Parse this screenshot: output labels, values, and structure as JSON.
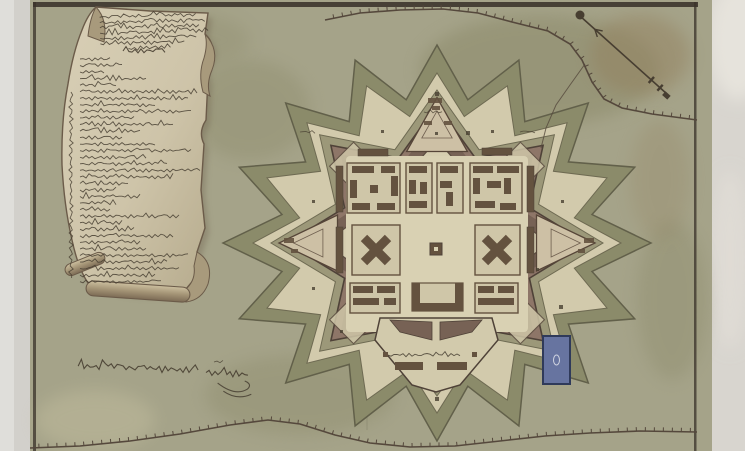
{
  "scene": {
    "width": 745,
    "height": 451,
    "photo": {
      "background": "#d2d0cb",
      "left_band": "#e0dfdb",
      "right_band": "#d8d5cf",
      "corner_highlight": "#e6e3dc"
    },
    "map_sheet": {
      "x": 30,
      "width": 682,
      "paper": "#a5a389",
      "paper_light": "#c8c2a2",
      "paper_dark": "#8a8868",
      "stain_brown": "#937f5c",
      "frame_color": "#3a322a",
      "frame_top_y": 2,
      "frame_left_x": 33,
      "frame_right_x": 694,
      "frame_thickness": 4,
      "crease_x": 367
    }
  },
  "palette": {
    "ink": "#473e31",
    "ink_light": "#5d5243",
    "glacis": "#8b8b6a",
    "glacis_edge": "#62604a",
    "covered_way": "#d2caac",
    "ditch": "#9c9879",
    "ditch_edge": "#6e6a52",
    "rampart": "#8e7668",
    "rampart_core": "#776255",
    "rampart_edge": "#4f4238",
    "enceinte": "#d6ceb0",
    "enceinte_edge": "#5c4d41",
    "parade": "#d9d1b3",
    "block_fill": "#cfc6a8",
    "building": "#64523f",
    "ravelin_fill": "#cdc0a5",
    "ravelin_edge": "#564538",
    "pond_fill": "#6774a0",
    "pond_edge": "#2f3a5a",
    "cartouche_paper": "#d2c8ae",
    "cartouche_paper_dark": "#bfb496",
    "cartouche_curl": "#a89a7c",
    "cartouche_edge": "#6b5b49",
    "road_ink": "#55483c"
  },
  "fort": {
    "cx": 437,
    "cy": 243,
    "rings": [
      {
        "name": "glacis",
        "n": 16,
        "rxo": 214,
        "ryo": 198,
        "rxi": 158,
        "ryi": 146,
        "fill": "glacis",
        "stroke": "glacis_edge",
        "sw": 1.5
      },
      {
        "name": "covered-way",
        "n": 16,
        "rxo": 184,
        "ryo": 170,
        "rxi": 140,
        "ryi": 129,
        "fill": "covered_way",
        "stroke": "ditch_edge",
        "sw": 1
      },
      {
        "name": "ditch",
        "n": 8,
        "rxo": 166,
        "ryo": 153,
        "rxi": 110,
        "ryi": 101,
        "fill": "ditch",
        "stroke": "ditch_edge",
        "sw": 1
      },
      {
        "name": "rampart",
        "n": 8,
        "rxo": 150,
        "ryo": 138,
        "rxi": 100,
        "ryi": 92,
        "fill": "rampart",
        "stroke": "rampart_edge",
        "sw": 1.6
      },
      {
        "name": "rampart-core",
        "n": 8,
        "rxo": 136,
        "ryo": 125,
        "rxi": 92,
        "ryi": 85,
        "fill": "rampart_core",
        "stroke": "",
        "sw": 0
      },
      {
        "name": "enceinte",
        "n": 8,
        "rxo": 112,
        "ryo": 103,
        "rxi": 80,
        "ryi": 74,
        "fill": "enceinte",
        "stroke": "enceinte_edge",
        "sw": 1.2
      }
    ],
    "ravelin_dirs_deg": [
      -90,
      0,
      180
    ],
    "ravelin": {
      "apex_r": 158,
      "base_r": 104,
      "half_angle_deg": 17,
      "y_scale": 0.92
    },
    "bastion_diamond": {
      "dirs_deg": [
        -45,
        -135,
        45,
        135
      ],
      "r": 118,
      "size": 24
    },
    "parade": {
      "x": 346,
      "y": 156,
      "w": 182,
      "h": 176
    },
    "blocks": [
      {
        "outline": [
          347,
          163,
          53,
          50
        ],
        "rects": [
          [
            352,
            166,
            22,
            7
          ],
          [
            381,
            166,
            14,
            7
          ],
          [
            350,
            180,
            7,
            18
          ],
          [
            391,
            176,
            7,
            20
          ],
          [
            352,
            203,
            18,
            7
          ],
          [
            377,
            203,
            18,
            7
          ],
          [
            370,
            185,
            8,
            8
          ]
        ]
      },
      {
        "outline": [
          406,
          163,
          26,
          50
        ],
        "rects": [
          [
            409,
            166,
            18,
            7
          ],
          [
            409,
            180,
            7,
            14
          ],
          [
            420,
            182,
            7,
            12
          ],
          [
            409,
            201,
            18,
            7
          ]
        ]
      },
      {
        "outline": [
          437,
          163,
          26,
          50
        ],
        "rects": [
          [
            440,
            166,
            18,
            7
          ],
          [
            440,
            181,
            12,
            7
          ],
          [
            446,
            192,
            7,
            14
          ]
        ]
      },
      {
        "outline": [
          470,
          163,
          52,
          50
        ],
        "rects": [
          [
            473,
            166,
            20,
            7
          ],
          [
            497,
            166,
            22,
            7
          ],
          [
            473,
            178,
            7,
            16
          ],
          [
            487,
            181,
            14,
            7
          ],
          [
            504,
            178,
            7,
            16
          ],
          [
            475,
            201,
            20,
            7
          ],
          [
            500,
            203,
            16,
            7
          ]
        ]
      },
      {
        "outline": [
          352,
          225,
          48,
          50
        ],
        "cross": [
          376,
          250
        ]
      },
      {
        "outline": [
          475,
          225,
          45,
          50
        ],
        "cross": [
          497,
          250
        ]
      },
      {
        "outline": [
          350,
          283,
          50,
          30
        ],
        "rects": [
          [
            353,
            286,
            20,
            7
          ],
          [
            377,
            286,
            18,
            7
          ],
          [
            353,
            298,
            26,
            7
          ],
          [
            384,
            298,
            12,
            7
          ]
        ]
      },
      {
        "outline": [
          475,
          283,
          43,
          30
        ],
        "rects": [
          [
            478,
            286,
            16,
            7
          ],
          [
            498,
            286,
            16,
            7
          ],
          [
            478,
            298,
            36,
            7
          ]
        ]
      }
    ],
    "u_building": {
      "x": 412,
      "y": 283,
      "w": 51,
      "h": 28,
      "wall": 8
    },
    "barracks": [
      [
        358,
        149,
        30,
        7
      ],
      [
        482,
        148,
        30,
        7
      ],
      [
        336,
        166,
        7,
        46
      ],
      [
        527,
        166,
        7,
        46
      ],
      [
        336,
        227,
        7,
        46
      ],
      [
        527,
        227,
        7,
        46
      ]
    ],
    "plaza_building": [
      430,
      243,
      12,
      12
    ],
    "citadel": {
      "poly": [
        [
          380,
          318
        ],
        [
          492,
          318
        ],
        [
          498,
          340
        ],
        [
          460,
          385
        ],
        [
          436,
          392
        ],
        [
          412,
          385
        ],
        [
          375,
          340
        ]
      ],
      "wedges": [
        [
          [
            390,
            320
          ],
          [
            432,
            322
          ],
          [
            432,
            340
          ],
          [
            400,
            332
          ]
        ],
        [
          [
            440,
            322
          ],
          [
            482,
            320
          ],
          [
            472,
            332
          ],
          [
            440,
            340
          ]
        ]
      ],
      "bars": [
        [
          395,
          362,
          28,
          8
        ],
        [
          437,
          362,
          30,
          8
        ]
      ],
      "squares": [
        [
          383,
          352,
          5,
          5
        ],
        [
          472,
          352,
          5,
          5
        ]
      ],
      "label": {
        "x": 388,
        "y": 355,
        "w": 72,
        "amp": 1.3
      }
    },
    "pond": {
      "x": 543,
      "y": 336,
      "w": 27,
      "h": 48
    },
    "ravelin_marks": [
      [
        428,
        98,
        14,
        5
      ],
      [
        432,
        106,
        8,
        4
      ],
      [
        424,
        121,
        8,
        4
      ],
      [
        444,
        121,
        8,
        4
      ],
      [
        584,
        238,
        10,
        5
      ],
      [
        578,
        249,
        7,
        4
      ],
      [
        284,
        238,
        10,
        5
      ],
      [
        291,
        249,
        7,
        4
      ]
    ],
    "markers": [
      [
        466,
        131,
        4
      ],
      [
        435,
        92,
        4
      ],
      [
        312,
        200,
        3
      ],
      [
        561,
        200,
        3
      ],
      [
        312,
        287,
        3
      ],
      [
        559,
        305,
        4
      ],
      [
        435,
        132,
        3
      ],
      [
        381,
        130,
        3
      ],
      [
        491,
        130,
        3
      ],
      [
        435,
        397,
        4
      ],
      [
        340,
        330,
        3
      ],
      [
        536,
        268,
        3
      ]
    ],
    "tiny_labels": [
      {
        "x": 424,
        "y": 112,
        "w": 20,
        "amp": 1
      },
      {
        "x": 300,
        "y": 132,
        "w": 16,
        "amp": 1
      },
      {
        "x": 520,
        "y": 132,
        "w": 16,
        "amp": 1
      },
      {
        "x": 214,
        "y": 362,
        "w": 10,
        "amp": 1.2
      }
    ]
  },
  "roads": {
    "top_palisade": [
      [
        325,
        20
      ],
      [
        360,
        13
      ],
      [
        400,
        10
      ],
      [
        443,
        9
      ],
      [
        478,
        13
      ],
      [
        512,
        22
      ],
      [
        548,
        31
      ],
      [
        570,
        44
      ],
      [
        582,
        60
      ],
      [
        592,
        82
      ],
      [
        604,
        99
      ],
      [
        622,
        108
      ],
      [
        652,
        114
      ],
      [
        697,
        120
      ]
    ],
    "bottom_palisade": [
      [
        30,
        448
      ],
      [
        80,
        446
      ],
      [
        130,
        441
      ],
      [
        180,
        434
      ],
      [
        230,
        425
      ],
      [
        268,
        420
      ],
      [
        300,
        424
      ],
      [
        335,
        435
      ],
      [
        370,
        443
      ],
      [
        410,
        447
      ],
      [
        455,
        446
      ],
      [
        500,
        441
      ],
      [
        545,
        436
      ],
      [
        590,
        433
      ],
      [
        640,
        431
      ],
      [
        697,
        432
      ]
    ],
    "access_path": [
      [
        585,
        64
      ],
      [
        570,
        85
      ],
      [
        556,
        105
      ],
      [
        546,
        128
      ],
      [
        541,
        148
      ]
    ],
    "tick_spacing": 9,
    "tick_len": 4
  },
  "compass": {
    "x1": 580,
    "y1": 16,
    "x2": 667,
    "y2": 94,
    "knob_r": 4.5,
    "barb_t": 0.17,
    "tail_ts": [
      0.82,
      0.92
    ],
    "tail_len": 8
  },
  "cartouche": {
    "panel_path": "M96,7 L150,11 L208,13 L205,34 Q216,44 210,58 Q204,68 208,78 L206,120 Q198,132 204,144 L201,190 L205,228 L197,252 L202,270 L186,289 Q150,296 118,290 L88,283 Q78,268 72,240 Q64,205 62,165 Q61,120 68,84 Q73,52 82,30 Q88,14 96,7 Z",
    "topleft_roll": "M96,7 Q108,20 104,42 L88,36 Q90,18 96,7 Z",
    "right_curl": "M205,34 Q220,50 212,70 Q206,84 210,96 L203,92 Q198,74 204,58 Q208,44 205,34 Z",
    "bottomright_curl": "M197,252 Q214,262 208,284 Q202,300 186,302 L186,289 Q196,280 194,266 Z",
    "bottom_roll": {
      "x": 86,
      "y": 284,
      "w": 104,
      "h": 15,
      "rot": 4
    },
    "side_roll": {
      "x": 64,
      "y": 258,
      "w": 42,
      "h": 12,
      "rot": -22
    },
    "header": {
      "x": 100,
      "y": 16,
      "lh": 5.3,
      "amp": 1.5,
      "widths": [
        98,
        106,
        100,
        108,
        96,
        86,
        44
      ]
    },
    "title": {
      "x": 123,
      "y": 51,
      "w": 42,
      "amp": 1.8
    },
    "legend": {
      "x": 80,
      "y": 59,
      "lh": 6.55,
      "amp": 1.4,
      "widths": [
        30,
        42,
        25,
        68,
        38,
        118,
        108,
        75,
        112,
        56,
        95,
        62,
        44,
        75,
        112,
        68,
        88,
        120,
        95,
        50,
        38,
        62,
        38,
        30,
        100,
        44,
        56,
        95,
        62,
        68,
        108,
        88,
        100,
        75,
        82
      ]
    },
    "side_text": {
      "x": 71,
      "y1": 92,
      "y2": 278,
      "amp": 1.6
    }
  },
  "signature": {
    "main": {
      "x": 78,
      "y": 369,
      "w": 122,
      "amp": 2.6
    },
    "second": {
      "x": 206,
      "y": 371,
      "w": 44,
      "amp": 3
    },
    "flourish": "M218,381 Q236,394 248,386 Q253,381 245,378 M224,389 Q238,398 252,391"
  },
  "texture_blotches": [
    {
      "cx": 540,
      "cy": 70,
      "rx": 120,
      "ry": 55,
      "fill": "paper_dark",
      "op": 0.5
    },
    {
      "cx": 640,
      "cy": 55,
      "rx": 50,
      "ry": 40,
      "fill": "stain_brown",
      "op": 0.45
    },
    {
      "cx": 250,
      "cy": 110,
      "rx": 60,
      "ry": 50,
      "fill": "paper_dark",
      "op": 0.35
    },
    {
      "cx": 300,
      "cy": 395,
      "rx": 95,
      "ry": 40,
      "fill": "paper_dark",
      "op": 0.35
    },
    {
      "cx": 437,
      "cy": 245,
      "rx": 150,
      "ry": 135,
      "fill": "paper_light",
      "op": 0.28
    },
    {
      "cx": 95,
      "cy": 420,
      "rx": 60,
      "ry": 30,
      "fill": "paper_light",
      "op": 0.4
    },
    {
      "cx": 672,
      "cy": 300,
      "rx": 35,
      "ry": 80,
      "fill": "paper_dark",
      "op": 0.35
    },
    {
      "cx": 180,
      "cy": 40,
      "rx": 70,
      "ry": 28,
      "fill": "paper_dark",
      "op": 0.3
    },
    {
      "cx": 660,
      "cy": 180,
      "rx": 30,
      "ry": 60,
      "fill": "stain_brown",
      "op": 0.22
    }
  ]
}
